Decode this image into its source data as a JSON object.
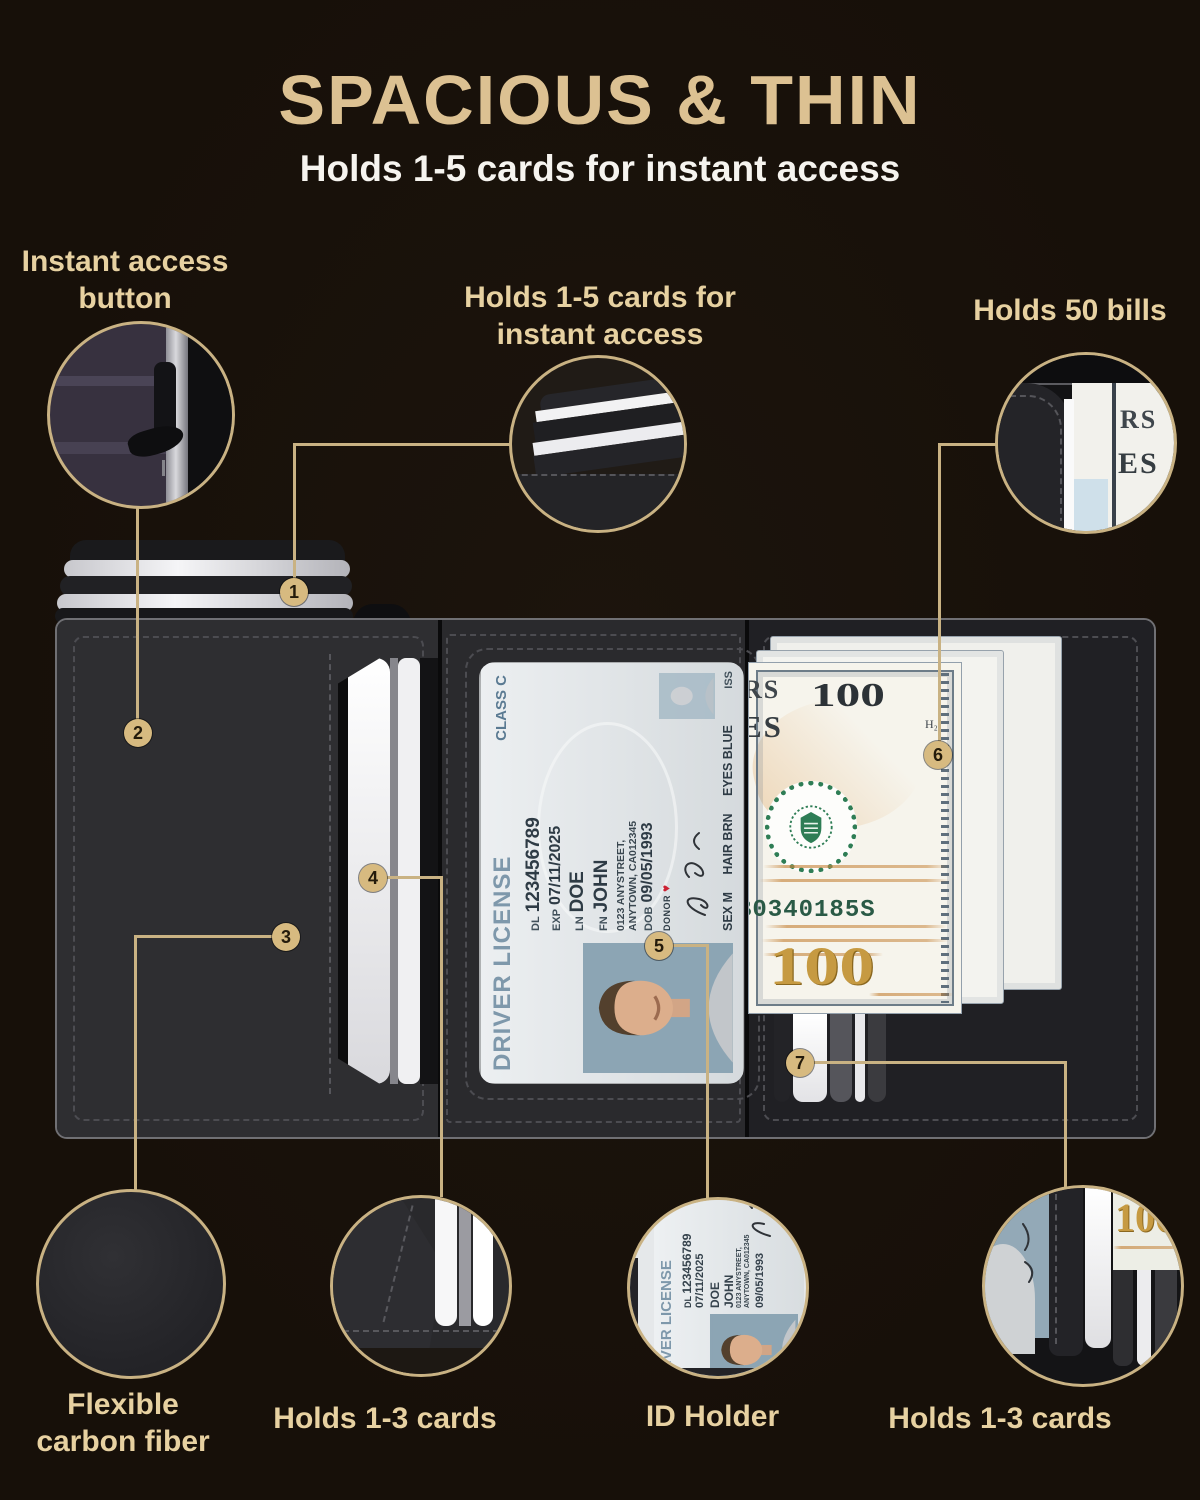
{
  "colors": {
    "background": "#171009",
    "gold_line": "#c9b283",
    "title_gold": "#dcc192",
    "label_tan": "#e7d1a1",
    "subtitle_white": "#f6f4ef",
    "badge_fill": "#d7ba80",
    "badge_text": "#241b0b",
    "seal_green": "#2e7d55",
    "serial_green": "#2a5a46",
    "gold_100": "#c69a42"
  },
  "header": {
    "title": "SPACIOUS & THIN",
    "subtitle": "Holds 1-5 cards for instant access"
  },
  "callouts": {
    "instant_access": {
      "line1": "Instant access",
      "line2": "button"
    },
    "top_cards": {
      "line1": "Holds 1-5 cards for",
      "line2": "instant access"
    },
    "bills": {
      "label": "Holds 50 bills"
    },
    "carbon": {
      "line1": "Flexible",
      "line2": "carbon fiber"
    },
    "left_cards": {
      "label": "Holds 1-3 cards"
    },
    "id_holder": {
      "label": "ID Holder"
    },
    "right_cards": {
      "label": "Holds 1-3 cards"
    }
  },
  "markers": [
    "1",
    "2",
    "3",
    "4",
    "5",
    "6",
    "7"
  ],
  "license": {
    "title": "DRIVER LICENSE",
    "class_label": "CLASS C",
    "dl_label": "DL",
    "dl_value": "123456789",
    "exp_label": "EXP",
    "exp_value": "07/11/2025",
    "ln_label": "LN",
    "ln_value": "DOE",
    "fn_label": "FN",
    "fn_value": "JOHN",
    "address_line1": "0123 ANYSTREET,",
    "address_line2": "ANYTOWN, CA012345",
    "dob_label": "DOB",
    "dob_value": "09/05/1993",
    "donor": "DONOR",
    "sex": "SEX M",
    "hair": "HAIR BRN",
    "eyes": "EYES BLUE",
    "iss": "ISS"
  },
  "bill": {
    "denomination": "100",
    "fragment_rs": "RS",
    "fragment_es": "ES",
    "plate": "H₂",
    "serial": "B0340185S"
  }
}
